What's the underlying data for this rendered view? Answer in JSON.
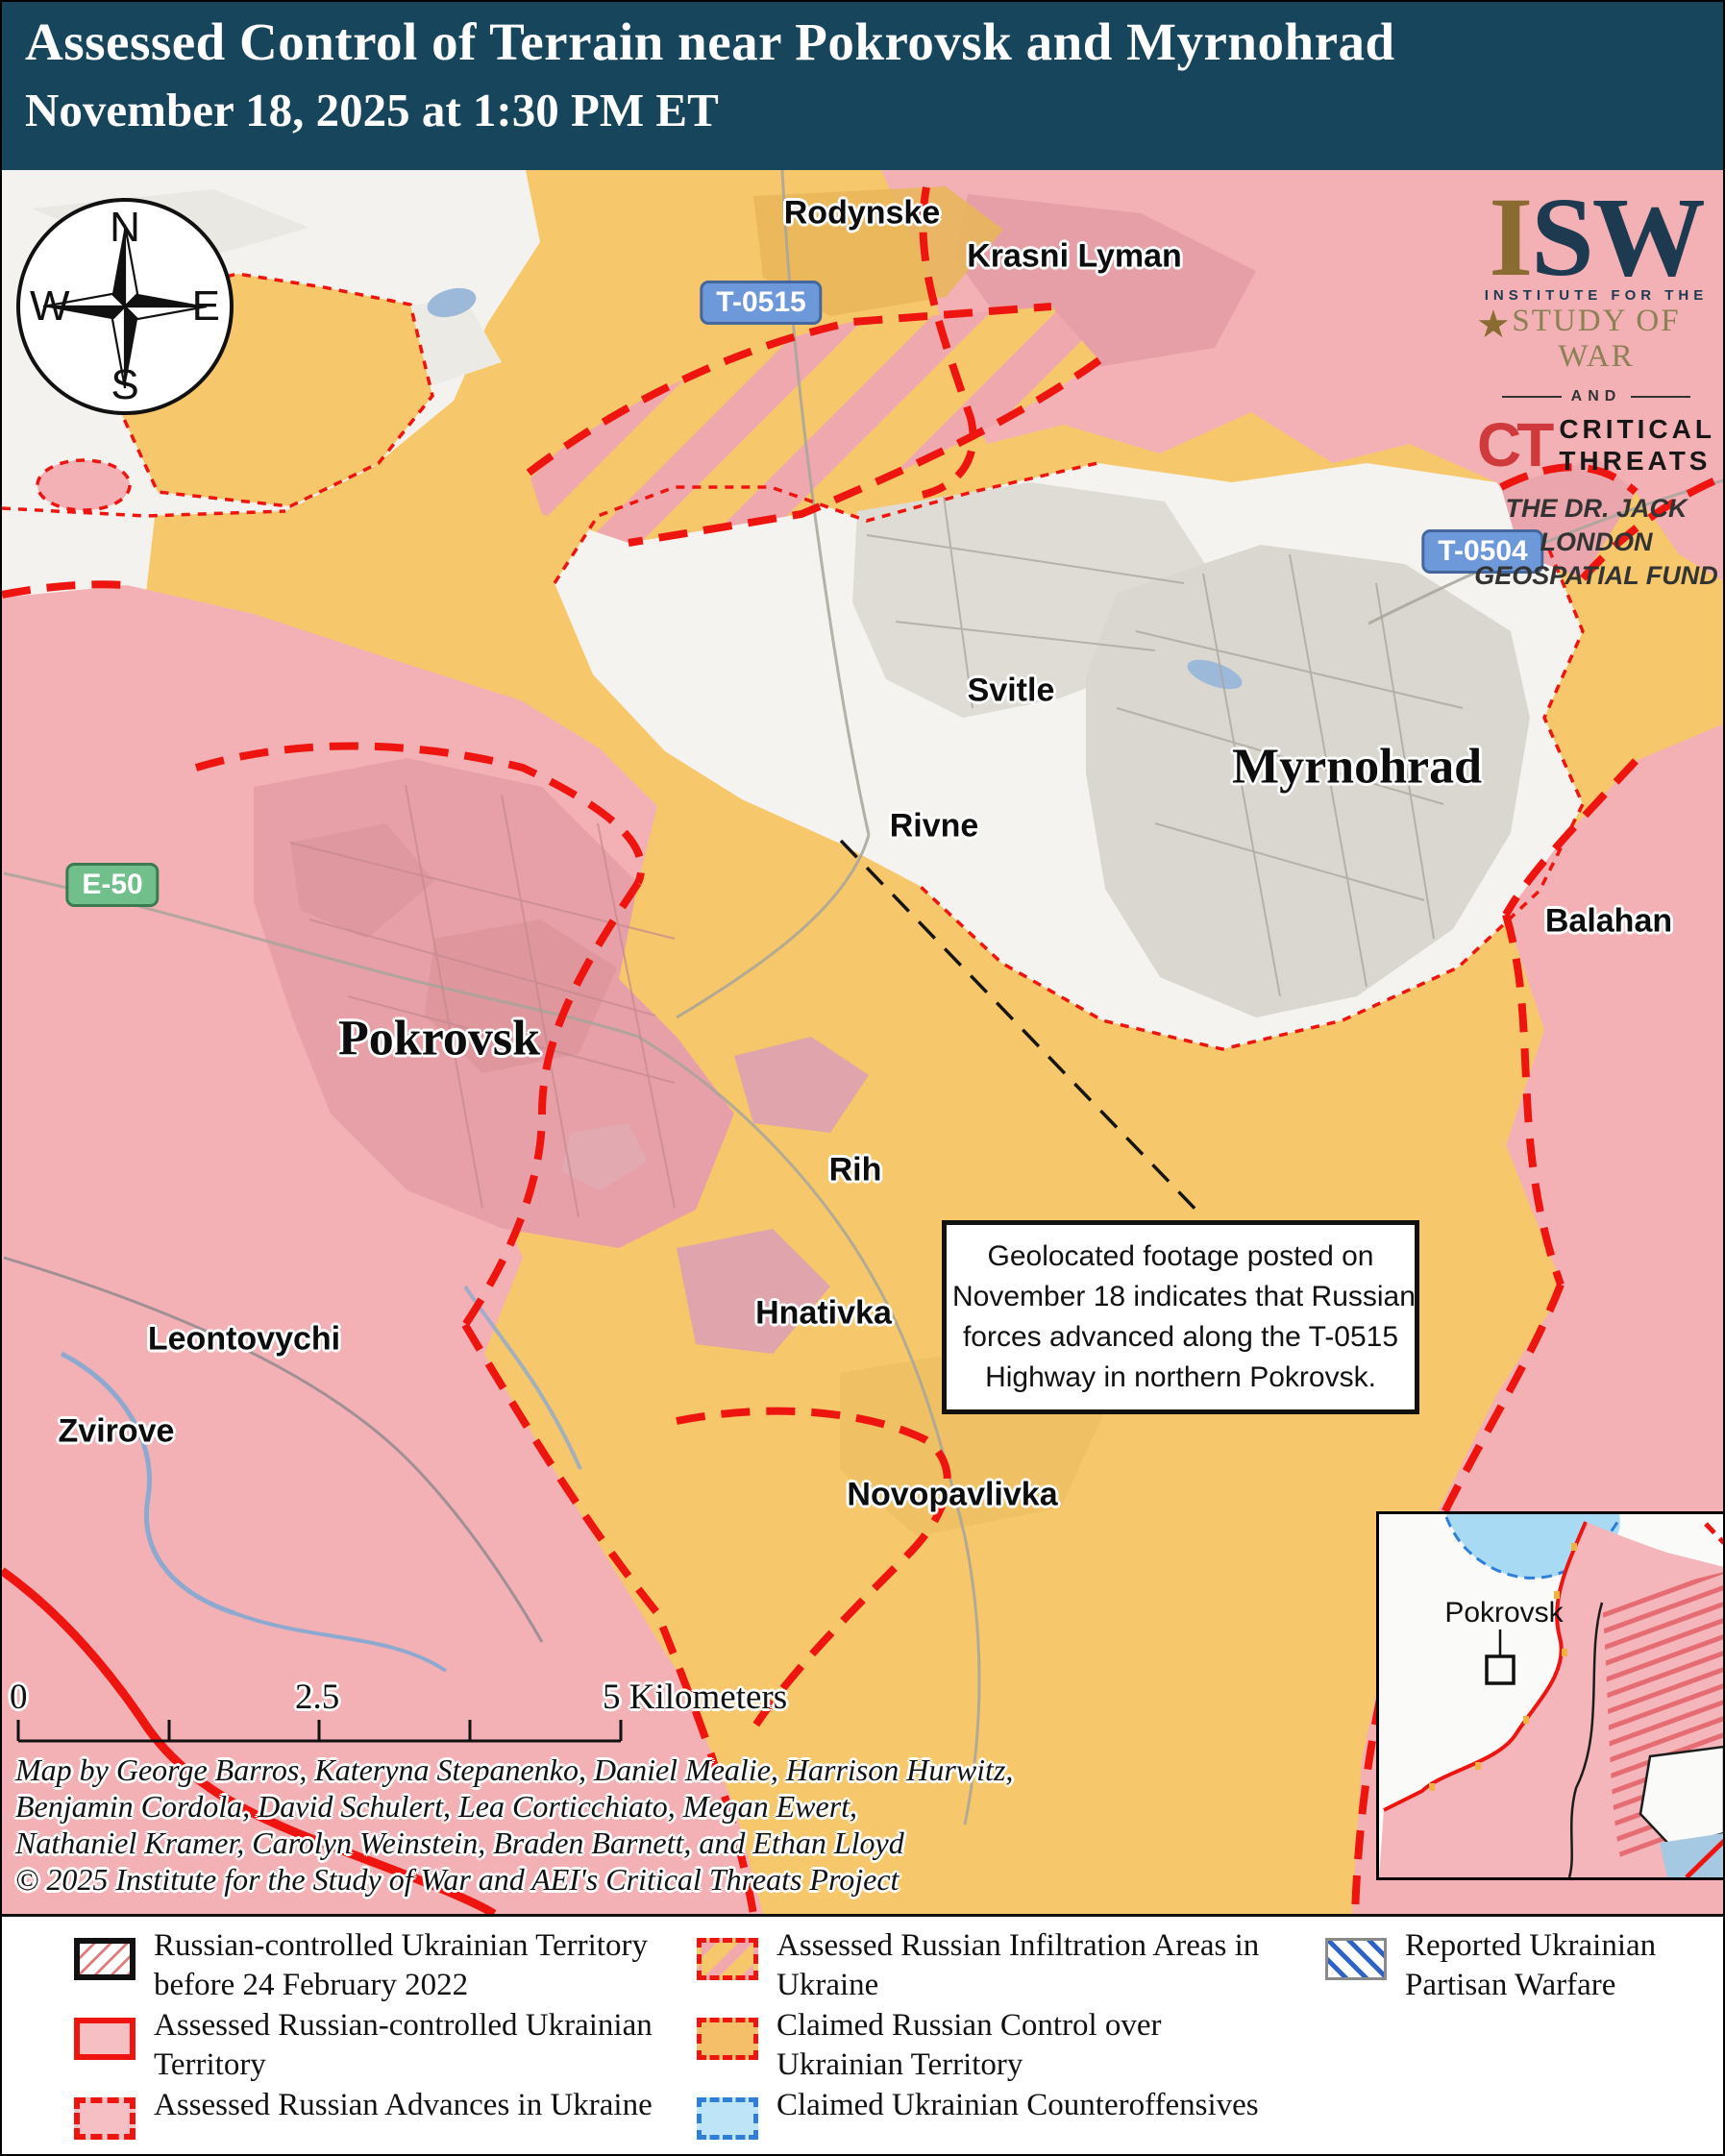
{
  "title": {
    "line1": "Assessed Control of Terrain near Pokrovsk and Myrnohrad",
    "line2": "November 18, 2025 at 1:30 PM ET"
  },
  "logo": {
    "isw_i": "I",
    "isw_sw": "SW",
    "star": "★",
    "institute": "INSTITUTE FOR THE",
    "study": "STUDY OF WAR",
    "and": "AND",
    "ct": "CT",
    "critical_line1": "CRITICAL",
    "critical_line2": "THREATS",
    "fund_line1": "THE DR. JACK LONDON",
    "fund_line2": "GEOSPATIAL FUND"
  },
  "compass": {
    "north": "N",
    "east": "E",
    "south": "S",
    "west": "W"
  },
  "roads": [
    {
      "label": "T-0515"
    },
    {
      "label": "T-0504"
    },
    {
      "label": "E-50"
    }
  ],
  "places": [
    {
      "name": "Rodynske"
    },
    {
      "name": "Krasni Lyman"
    },
    {
      "name": "Svitle"
    },
    {
      "name": "Myrnohrad"
    },
    {
      "name": "Rivne"
    },
    {
      "name": "Balahan"
    },
    {
      "name": "Pokrovsk"
    },
    {
      "name": "Rih"
    },
    {
      "name": "Hnativka"
    },
    {
      "name": "Leontovychi"
    },
    {
      "name": "Zvirove"
    },
    {
      "name": "Novopavlivka"
    }
  ],
  "annotation": {
    "lines": [
      "Geolocated footage posted on",
      "November 18 indicates that Russian",
      "forces advanced along the T-0515",
      "Highway in northern Pokrovsk."
    ]
  },
  "scale_bar": {
    "start": "0",
    "middle": "2.5",
    "end": "5 Kilometers"
  },
  "credits": [
    "Map by George Barros, Kateryna Stepanenko, Daniel Mealie, Harrison Hurwitz,",
    "Benjamin Cordola, David Schulert, Lea Corticchiato, Megan Ewert,",
    "Nathaniel Kramer, Carolyn Weinstein, Braden Barnett, and Ethan Lloyd",
    "© 2025 Institute for the Study of War and AEI's Critical Threats Project"
  ],
  "inset": {
    "label": "Pokrovsk"
  },
  "legend": {
    "items": [
      {
        "label": "Russian-controlled Ukrainian Territory before 24 February 2022"
      },
      {
        "label": "Assessed Russian-controlled Ukrainian Territory"
      },
      {
        "label": "Assessed Russian Advances in Ukraine"
      },
      {
        "label": "Assessed Russian Infiltration Areas in Ukraine"
      },
      {
        "label": "Claimed Russian Control over Ukrainian Territory"
      },
      {
        "label": "Claimed Ukrainian Counteroffensives"
      },
      {
        "label": "Reported Ukrainian Partisan Warfare"
      }
    ]
  },
  "colors": {
    "title_bg": "#17455c",
    "claimed_russian_yellow": "#f6c76b",
    "assessed_russian_pink": "#f3b1b5",
    "red_line": "#ee1511",
    "counteroffensive_blue": "#2f7fd9",
    "partisan_blue": "#2f62c7",
    "road_badge_blue": "#6d98da",
    "road_badge_green": "#71bf8a"
  }
}
